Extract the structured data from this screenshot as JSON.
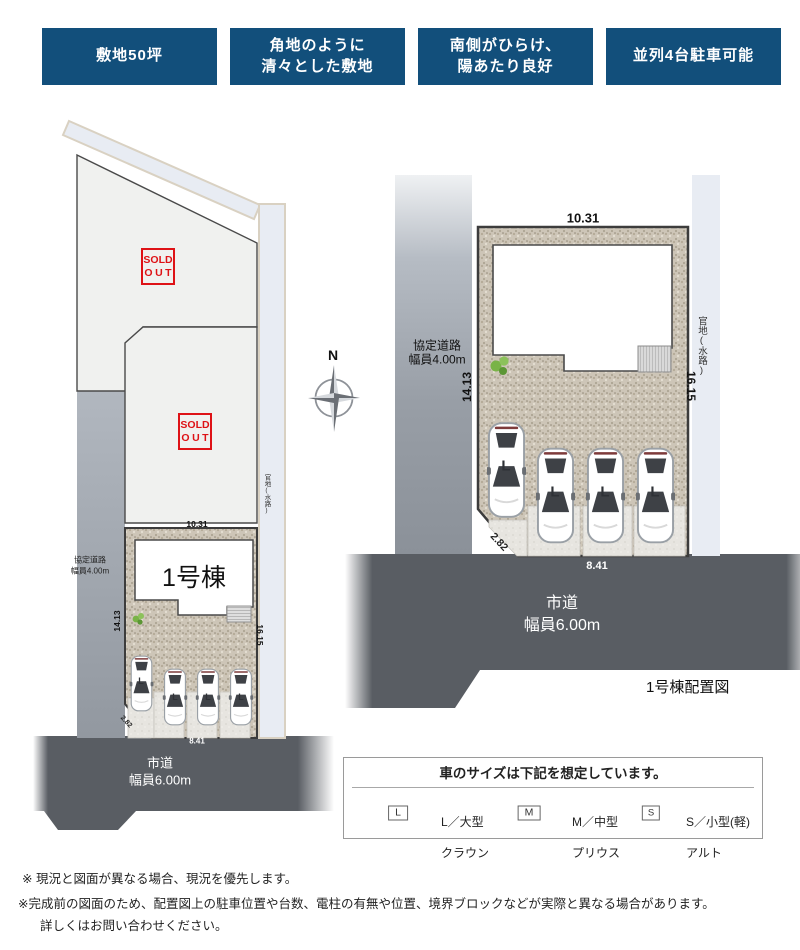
{
  "badges": [
    {
      "label": "敷地50坪"
    },
    {
      "label": "角地のように\n清々とした敷地"
    },
    {
      "label": "南側がひらけ、\n陽あたり良好"
    },
    {
      "label": "並列4台駐車可能"
    }
  ],
  "sold_out": {
    "line1": "SOLD",
    "line2": "OUT"
  },
  "compass": {
    "label": "N"
  },
  "plans": {
    "left": {
      "building_label": "1号棟",
      "dim_top": "10.31",
      "dim_left": "14.13",
      "dim_right": "16.15",
      "dim_corner": "2.82",
      "dim_bottom": "8.41",
      "side_road_name": "協定道路",
      "side_road_width": "幅員4.00m",
      "main_road_name": "市道",
      "main_road_width": "幅員6.00m",
      "edge_label": "官地(水路)",
      "parking": [
        "L",
        "L",
        "L",
        "L"
      ]
    },
    "right": {
      "caption": "1号棟配置図",
      "dim_top": "10.31",
      "dim_left": "14.13",
      "dim_right": "16.15",
      "dim_corner": "2.82",
      "dim_bottom": "8.41",
      "side_road_name": "協定道路",
      "side_road_width": "幅員4.00m",
      "main_road_name": "市道",
      "main_road_width": "幅員6.00m",
      "edge_label": "官地(水路)",
      "parking": [
        "L",
        "L",
        "L",
        "L"
      ]
    }
  },
  "legend": {
    "title": "車のサイズは下記を想定しています。",
    "items": [
      {
        "code": "L",
        "size": "L／大型",
        "model": "クラウン"
      },
      {
        "code": "M",
        "size": "M／中型",
        "model": "プリウス"
      },
      {
        "code": "S",
        "size": "S／小型(軽)",
        "model": "アルト"
      }
    ]
  },
  "notes": [
    "※ 現況と図面が異なる場合、現況を優先します。",
    "※完成前の図面のため、配置図上の駐車位置や台数、電柱の有無や位置、境界ブロックなどが実際と異なる場合があります。",
    "詳しくはお問い合わせください。"
  ],
  "colors": {
    "badge_blue": "#124F7B",
    "sold_out_red": "#DE1216",
    "main_road_gray": "#595D63",
    "side_road_gray": "#99A0A8",
    "waterway_strip": "#E8ECF3",
    "gravel": "#CDC5B7"
  }
}
